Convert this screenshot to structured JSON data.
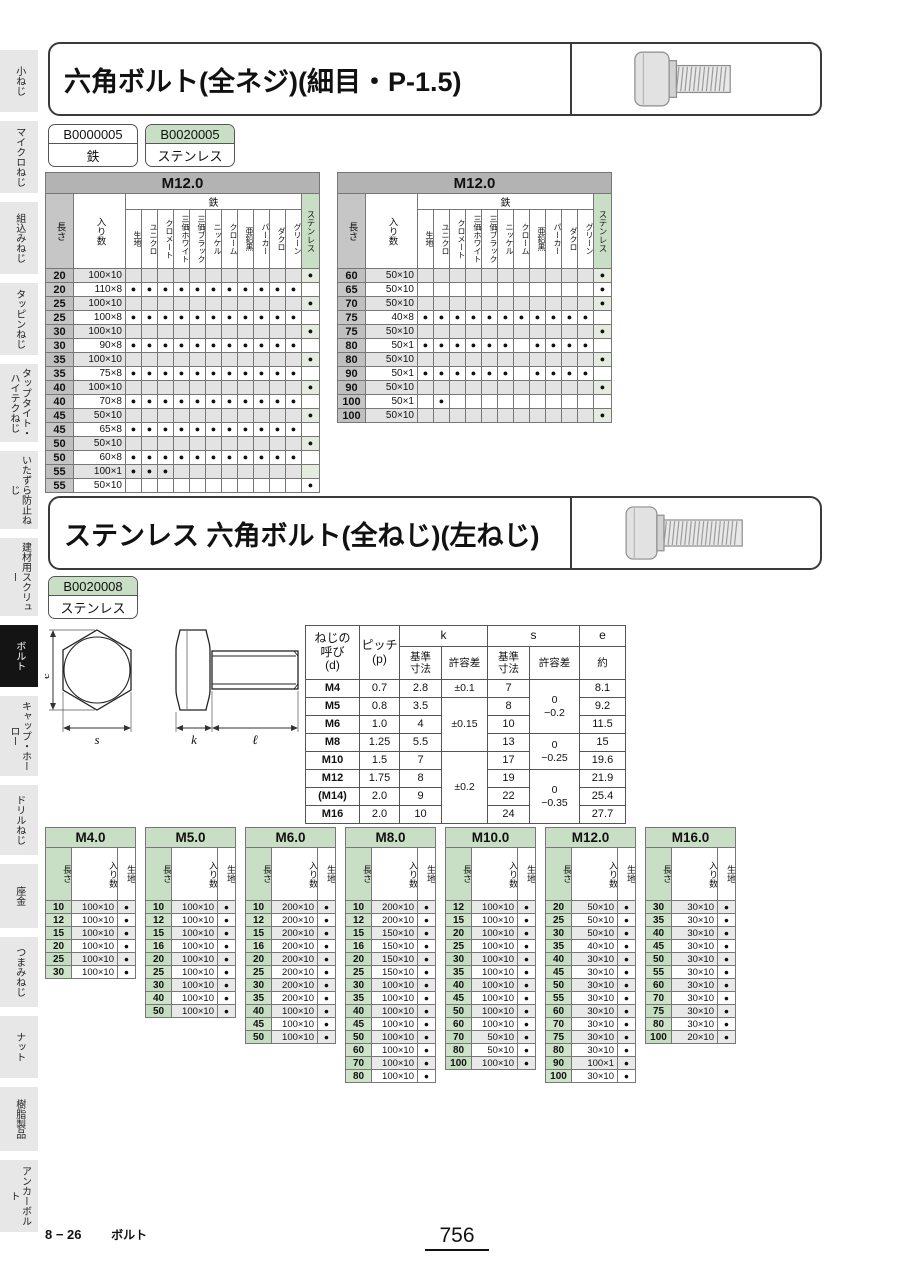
{
  "dot": "●",
  "colors": {
    "accent_green": "#c9dfc5",
    "green_tint": "#e4ecdf",
    "header_gray": "#b3b3b3",
    "length_gray": "#c6c6c6",
    "row_shade": "#e3e3e3",
    "sidebar_gray": "#e7e7e7",
    "active_black": "#141414"
  },
  "sidebar": {
    "active_index": 7,
    "items": [
      "小ねじ",
      "マイクロねじ",
      "組込みねじ",
      "タッピンねじ",
      "タップタイト・ハイテクねじ",
      "いたずら防止ねじ",
      "建材用スクリュー",
      "ボルト",
      "キャップ・ホーロー",
      "ドリルねじ",
      "座金",
      "つまみねじ",
      "ナット",
      "樹脂製品",
      "アンカーボルト"
    ]
  },
  "section1": {
    "title": "六角ボルト(全ネジ)(細目・P-1.5)",
    "codes": [
      {
        "code": "B0000005",
        "material": "鉄",
        "highlight": false
      },
      {
        "code": "B0020005",
        "material": "ステンレス",
        "highlight": true
      }
    ],
    "len_label": "長さ",
    "qty_label": "入り数",
    "iron_label": "鉄",
    "stainless_label": "ステンレス",
    "finishes": [
      "生地",
      "ユニクロ",
      "クロメート",
      "三価ホワイト",
      "三価ブラック",
      "ニッケル",
      "クローム",
      "亜鉛黒",
      "パーカー",
      "ダクロ",
      "グリーン"
    ],
    "tables": [
      {
        "title": "M12.0",
        "rows": [
          {
            "len": "20",
            "qty": "100×10",
            "iron": "00000000000",
            "st": 1
          },
          {
            "len": "20",
            "qty": "110×8",
            "iron": "11111111111",
            "st": 0
          },
          {
            "len": "25",
            "qty": "100×10",
            "iron": "00000000000",
            "st": 1
          },
          {
            "len": "25",
            "qty": "100×8",
            "iron": "11111111111",
            "st": 0
          },
          {
            "len": "30",
            "qty": "100×10",
            "iron": "00000000000",
            "st": 1
          },
          {
            "len": "30",
            "qty": "90×8",
            "iron": "11111111111",
            "st": 0
          },
          {
            "len": "35",
            "qty": "100×10",
            "iron": "00000000000",
            "st": 1
          },
          {
            "len": "35",
            "qty": "75×8",
            "iron": "11111111111",
            "st": 0
          },
          {
            "len": "40",
            "qty": "100×10",
            "iron": "00000000000",
            "st": 1
          },
          {
            "len": "40",
            "qty": "70×8",
            "iron": "11111111111",
            "st": 0
          },
          {
            "len": "45",
            "qty": "50×10",
            "iron": "00000000000",
            "st": 1
          },
          {
            "len": "45",
            "qty": "65×8",
            "iron": "11111111111",
            "st": 0
          },
          {
            "len": "50",
            "qty": "50×10",
            "iron": "00000000000",
            "st": 1
          },
          {
            "len": "50",
            "qty": "60×8",
            "iron": "11111111111",
            "st": 0
          },
          {
            "len": "55",
            "qty": "100×1",
            "iron": "11100000000",
            "st": 0
          },
          {
            "len": "55",
            "qty": "50×10",
            "iron": "00000000000",
            "st": 1
          }
        ]
      },
      {
        "title": "M12.0",
        "rows": [
          {
            "len": "60",
            "qty": "50×10",
            "iron": "00000000000",
            "st": 1
          },
          {
            "len": "65",
            "qty": "50×10",
            "iron": "00000000000",
            "st": 1
          },
          {
            "len": "70",
            "qty": "50×10",
            "iron": "00000000000",
            "st": 1
          },
          {
            "len": "75",
            "qty": "40×8",
            "iron": "11111111111",
            "st": 0
          },
          {
            "len": "75",
            "qty": "50×10",
            "iron": "00000000000",
            "st": 1
          },
          {
            "len": "80",
            "qty": "50×1",
            "iron": "11111101111",
            "st": 0
          },
          {
            "len": "80",
            "qty": "50×10",
            "iron": "00000000000",
            "st": 1
          },
          {
            "len": "90",
            "qty": "50×1",
            "iron": "11111101111",
            "st": 0
          },
          {
            "len": "90",
            "qty": "50×10",
            "iron": "00000000000",
            "st": 1
          },
          {
            "len": "100",
            "qty": "50×1",
            "iron": "01000000000",
            "st": 0
          },
          {
            "len": "100",
            "qty": "50×10",
            "iron": "00000000000",
            "st": 1
          }
        ]
      }
    ]
  },
  "section2": {
    "title": "ステンレス 六角ボルト(全ねじ)(左ねじ)",
    "code": {
      "code": "B0020008",
      "material": "ステンレス"
    },
    "diagram": {
      "e": "e",
      "s": "s",
      "k": "k",
      "l": "ℓ"
    },
    "dim_table": {
      "h_d": "ねじの\n呼び\n(d)",
      "h_p": "ピッチ\n(p)",
      "h_k": "k",
      "h_s": "s",
      "h_e": "e",
      "h_base": "基準\n寸法",
      "h_tol": "許容差",
      "h_approx": "約",
      "rows": [
        {
          "d": "M4",
          "p": "0.7",
          "k": "2.8",
          "s": "7",
          "e": "8.1"
        },
        {
          "d": "M5",
          "p": "0.8",
          "k": "3.5",
          "s": "8",
          "e": "9.2"
        },
        {
          "d": "M6",
          "p": "1.0",
          "k": "4",
          "s": "10",
          "e": "11.5"
        },
        {
          "d": "M8",
          "p": "1.25",
          "k": "5.5",
          "s": "13",
          "e": "15"
        },
        {
          "d": "M10",
          "p": "1.5",
          "k": "7",
          "s": "17",
          "e": "19.6"
        },
        {
          "d": "M12",
          "p": "1.75",
          "k": "8",
          "s": "19",
          "e": "21.9"
        },
        {
          "d": "(M14)",
          "p": "2.0",
          "k": "9",
          "s": "22",
          "e": "25.4"
        },
        {
          "d": "M16",
          "p": "2.0",
          "k": "10",
          "s": "24",
          "e": "27.7"
        }
      ],
      "k_tol": [
        {
          "text": "±0.1",
          "span": 1
        },
        {
          "text": "±0.15",
          "span": 3
        },
        {
          "text": "±0.2",
          "span": 4
        }
      ],
      "s_tol": [
        {
          "text": "0\n−0.2",
          "span": 3
        },
        {
          "text": "0\n−0.25",
          "span": 2
        },
        {
          "text": "0\n−0.35",
          "span": 3
        }
      ]
    },
    "size_col_headers": {
      "len": "長さ",
      "qty": "入り数",
      "kiji": "生地"
    },
    "size_tables": [
      {
        "title": "M4.0",
        "rows": [
          [
            "10",
            "100×10"
          ],
          [
            "12",
            "100×10"
          ],
          [
            "15",
            "100×10"
          ],
          [
            "20",
            "100×10"
          ],
          [
            "25",
            "100×10"
          ],
          [
            "30",
            "100×10"
          ]
        ]
      },
      {
        "title": "M5.0",
        "rows": [
          [
            "10",
            "100×10"
          ],
          [
            "12",
            "100×10"
          ],
          [
            "15",
            "100×10"
          ],
          [
            "16",
            "100×10"
          ],
          [
            "20",
            "100×10"
          ],
          [
            "25",
            "100×10"
          ],
          [
            "30",
            "100×10"
          ],
          [
            "40",
            "100×10"
          ],
          [
            "50",
            "100×10"
          ]
        ]
      },
      {
        "title": "M6.0",
        "rows": [
          [
            "10",
            "200×10"
          ],
          [
            "12",
            "200×10"
          ],
          [
            "15",
            "200×10"
          ],
          [
            "16",
            "200×10"
          ],
          [
            "20",
            "200×10"
          ],
          [
            "25",
            "200×10"
          ],
          [
            "30",
            "200×10"
          ],
          [
            "35",
            "200×10"
          ],
          [
            "40",
            "100×10"
          ],
          [
            "45",
            "100×10"
          ],
          [
            "50",
            "100×10"
          ]
        ]
      },
      {
        "title": "M8.0",
        "rows": [
          [
            "10",
            "200×10"
          ],
          [
            "12",
            "200×10"
          ],
          [
            "15",
            "150×10"
          ],
          [
            "16",
            "150×10"
          ],
          [
            "20",
            "150×10"
          ],
          [
            "25",
            "150×10"
          ],
          [
            "30",
            "100×10"
          ],
          [
            "35",
            "100×10"
          ],
          [
            "40",
            "100×10"
          ],
          [
            "45",
            "100×10"
          ],
          [
            "50",
            "100×10"
          ],
          [
            "60",
            "100×10"
          ],
          [
            "70",
            "100×10"
          ],
          [
            "80",
            "100×10"
          ]
        ]
      },
      {
        "title": "M10.0",
        "rows": [
          [
            "12",
            "100×10"
          ],
          [
            "15",
            "100×10"
          ],
          [
            "20",
            "100×10"
          ],
          [
            "25",
            "100×10"
          ],
          [
            "30",
            "100×10"
          ],
          [
            "35",
            "100×10"
          ],
          [
            "40",
            "100×10"
          ],
          [
            "45",
            "100×10"
          ],
          [
            "50",
            "100×10"
          ],
          [
            "60",
            "100×10"
          ],
          [
            "70",
            "50×10"
          ],
          [
            "80",
            "50×10"
          ],
          [
            "100",
            "100×10"
          ]
        ]
      },
      {
        "title": "M12.0",
        "rows": [
          [
            "20",
            "50×10"
          ],
          [
            "25",
            "50×10"
          ],
          [
            "30",
            "50×10"
          ],
          [
            "35",
            "40×10"
          ],
          [
            "40",
            "30×10"
          ],
          [
            "45",
            "30×10"
          ],
          [
            "50",
            "30×10"
          ],
          [
            "55",
            "30×10"
          ],
          [
            "60",
            "30×10"
          ],
          [
            "70",
            "30×10"
          ],
          [
            "75",
            "30×10"
          ],
          [
            "80",
            "30×10"
          ],
          [
            "90",
            "100×1"
          ],
          [
            "100",
            "30×10"
          ]
        ]
      },
      {
        "title": "M16.0",
        "rows": [
          [
            "30",
            "30×10"
          ],
          [
            "35",
            "30×10"
          ],
          [
            "40",
            "30×10"
          ],
          [
            "45",
            "30×10"
          ],
          [
            "50",
            "30×10"
          ],
          [
            "55",
            "30×10"
          ],
          [
            "60",
            "30×10"
          ],
          [
            "70",
            "30×10"
          ],
          [
            "75",
            "30×10"
          ],
          [
            "80",
            "30×10"
          ],
          [
            "100",
            "20×10"
          ]
        ]
      }
    ]
  },
  "footer": {
    "section": "8 − 26",
    "category": "ボルト",
    "page": "756"
  }
}
